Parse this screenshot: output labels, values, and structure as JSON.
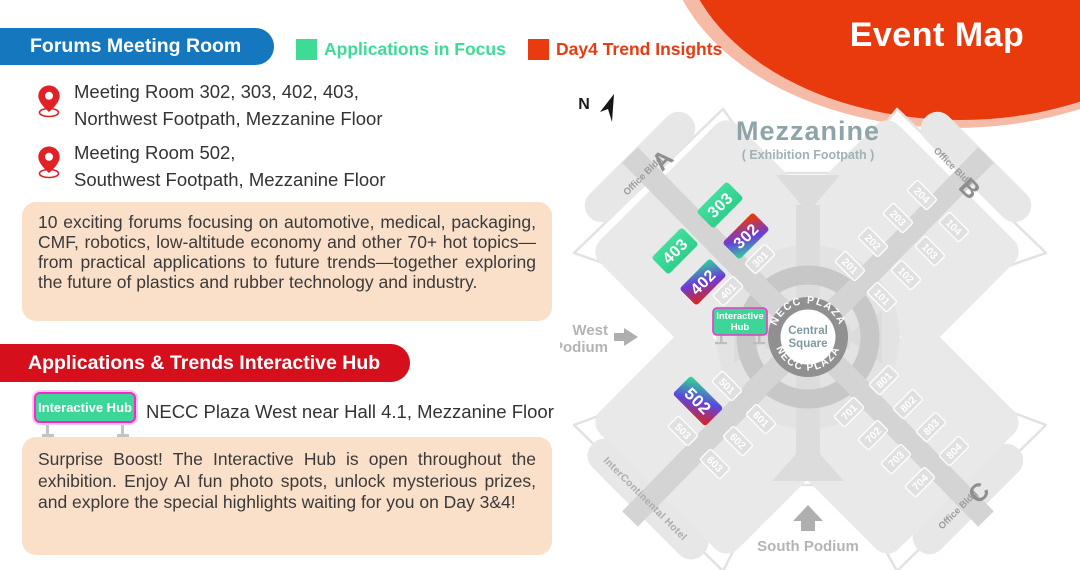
{
  "poster": {
    "banner_title": "Event Map",
    "forums_pill": "Forums Meeting Room",
    "legend": [
      {
        "label": "Applications in Focus",
        "color": "#3EDB96"
      },
      {
        "label": "Day4 Trend Insights",
        "color": "#EA3A10"
      }
    ],
    "locations": [
      {
        "line1": "Meeting Room 302, 303, 402, 403,",
        "line2": "Northwest Footpath, Mezzanine Floor"
      },
      {
        "line1": "Meeting Room 502,",
        "line2": "Southwest Footpath, Mezzanine Floor"
      }
    ],
    "forums_paragraph": "10 exciting forums focusing on automotive, medical, packaging, CMF, robotics, low-altitude economy and other 70+ hot topics—from practical applications to future trends—together exploring the future of plastics and rubber technology and industry.",
    "hub_pill": "Applications & Trends Interactive Hub",
    "hub_sign_label": "Interactive Hub",
    "hub_location": "NECC Plaza West near Hall 4.1, Mezzanine Floor",
    "hub_paragraph": "Surprise Boost! The Interactive Hub is open throughout the exhibition. Enjoy AI fun photo spots, unlock mysterious prizes, and explore the special highlights waiting for you on Day 3&4!"
  },
  "map": {
    "north": "N",
    "title": "Mezzanine",
    "subtitle": "( Exhibition Footpath )",
    "plaza_top": "NECC PLAZA",
    "plaza_bottom": "NECC PLAZA",
    "center_line1": "Central",
    "center_line2": "Square",
    "office_bldg": "Office Bldg",
    "bldg_a": "A",
    "bldg_b": "B",
    "bldg_c": "C",
    "hotel": "InterContinental Hotel",
    "west_line1": "West",
    "west_line2": "Podium",
    "south_podium": "South Podium",
    "hub_line1": "Interactive",
    "hub_line2": "Hub",
    "tiles": {
      "101": "101",
      "102": "102",
      "103": "103",
      "104": "104",
      "201": "201",
      "202": "202",
      "203": "203",
      "204": "204",
      "301": "301",
      "302": "302",
      "303": "303",
      "401": "401",
      "402": "402",
      "403": "403",
      "501": "501",
      "502": "502",
      "503": "503",
      "601": "601",
      "602": "602",
      "603": "603",
      "701": "701",
      "702": "702",
      "703": "703",
      "704": "704",
      "801": "801",
      "802": "802",
      "803": "803",
      "804": "804"
    }
  },
  "colors": {
    "accent_blue": "#1577BE",
    "accent_red_pill": "#D5101C",
    "legend_green": "#3EDB96",
    "legend_orange_red": "#EA3A10",
    "banner_red": "#E93A0E",
    "banner_pink": "#F5BBA7",
    "hub_green": "#3DD598",
    "hub_border_magenta": "#F02BC8",
    "peach_panel": "#FADFC9",
    "pin_red": "#E02227",
    "hall_green": "#3BD794"
  }
}
